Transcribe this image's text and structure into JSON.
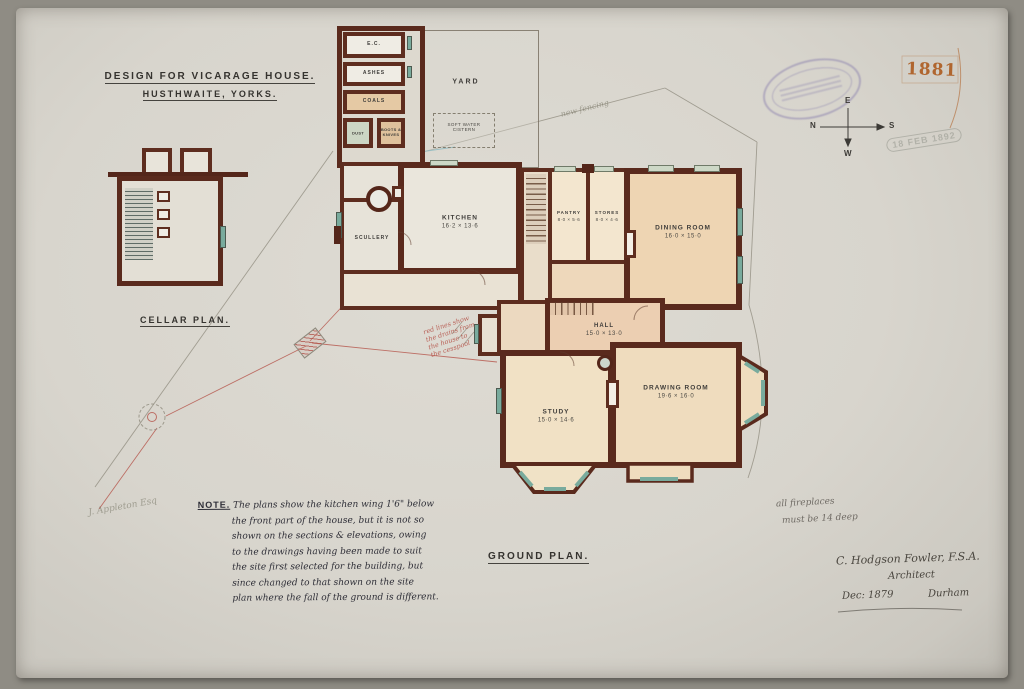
{
  "title": {
    "line1": "DESIGN FOR VICARAGE HOUSE.",
    "line2": "HUSTHWAITE, YORKS."
  },
  "corner": {
    "year": "1881",
    "date_stamp": "18 FEB 1892"
  },
  "compass": {
    "top": "E",
    "left": "N",
    "right": "S",
    "bottom": "W"
  },
  "labels": {
    "cellar": "CELLAR PLAN.",
    "ground": "GROUND PLAN."
  },
  "rooms": {
    "ec": {
      "name": "E.C."
    },
    "ashes": {
      "name": "ASHES"
    },
    "coals": {
      "name": "COALS"
    },
    "dust": {
      "name": "DUST"
    },
    "boots": {
      "name": "BOOTS & KNIVES"
    },
    "yard": {
      "name": "YARD"
    },
    "cistern": {
      "line1": "SOFT WATER",
      "line2": "CISTERN"
    },
    "scullery": {
      "name": "SCULLERY"
    },
    "kitchen": {
      "name": "KITCHEN",
      "dims": "16·2 × 13·6"
    },
    "pantry": {
      "name": "PANTRY",
      "dims": "8·0 × 5·6"
    },
    "stores": {
      "name": "STORES",
      "dims": "8·0 × 4·6"
    },
    "dining": {
      "name": "DINING ROOM",
      "dims": "16·0 × 15·0"
    },
    "hall": {
      "name": "HALL",
      "dims": "15·0 × 13·0"
    },
    "study": {
      "name": "STUDY",
      "dims": "15·0 × 14·6"
    },
    "drawing": {
      "name": "DRAWING ROOM",
      "dims": "19·6 × 16·0"
    }
  },
  "note": {
    "label": "NOTE.",
    "lines": [
      "The plans show the kitchen wing 1'6\" below",
      "the front part of the house, but it is not so",
      "shown on the sections & elevations, owing",
      "to the drawings having been made to suit",
      "the site first selected for the building, but",
      "since changed to that shown on the site",
      "plan where the fall of the ground is different."
    ]
  },
  "inscriptions": {
    "fireplaces1": "all fireplaces",
    "fireplaces2": "must be 14 deep",
    "architect": "C. Hodgson Fowler, F.S.A.",
    "role": "Architect",
    "date": "Dec: 1879",
    "place": "Durham",
    "fence": "new fencing",
    "owner": "J. Appleton Esq",
    "red_note": [
      "red lines show",
      "the drains from",
      "the house to",
      "the cesspool"
    ]
  },
  "colors": {
    "wall": "#5a2a1d",
    "wash_pink": "#eed6b8",
    "window_teal": "#79ab9d",
    "red_ink": "#b5544a",
    "pencil": "#8d897c",
    "stamp_purple": "#7d73aa",
    "year_orange": "#b0662f"
  }
}
